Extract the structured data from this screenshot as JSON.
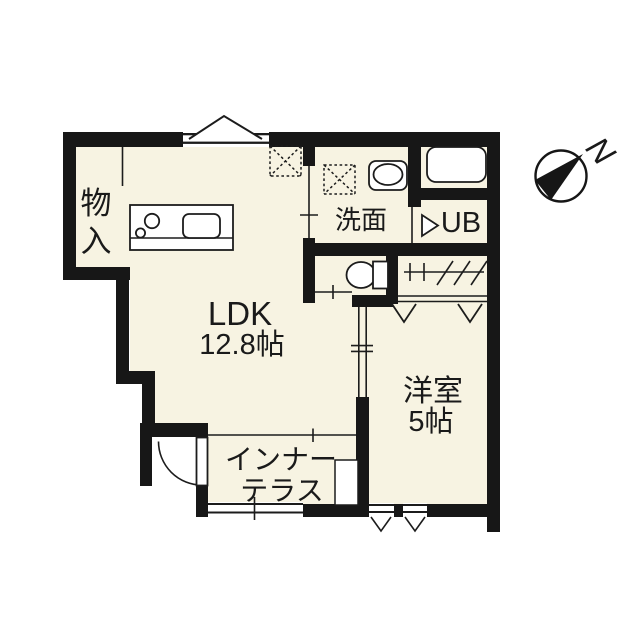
{
  "plan": {
    "background": "#ffffff",
    "wall_color": "#171717",
    "floor_color": "#f7f3e2",
    "line_color": "#1c1c1c"
  },
  "rooms": {
    "ldk": {
      "label": "LDK",
      "size": "12.8帖"
    },
    "western_room": {
      "label": "洋室",
      "size": "5帖"
    },
    "washroom": {
      "label": "洗面"
    },
    "unit_bath": {
      "label": "UB"
    },
    "storage": {
      "label": "物入",
      "chars": [
        "物",
        "入"
      ]
    },
    "inner_terrace": {
      "label": "インナーテラス",
      "lines": [
        "インナー",
        "テラス"
      ]
    }
  },
  "compass": {
    "north_label": "N"
  },
  "icons": [
    "compass-north-icon",
    "kitchen-counter-icon",
    "stove-burners-icon",
    "kitchen-sink-icon",
    "refrigerator-space-icon",
    "washing-machine-space-icon",
    "washbasin-icon",
    "bathtub-icon",
    "toilet-icon",
    "hanger-pipe-icon",
    "closet-folding-door-icon",
    "unit-bath-door-icon",
    "entrance-door-icon",
    "window-icon",
    "vent-icon"
  ]
}
